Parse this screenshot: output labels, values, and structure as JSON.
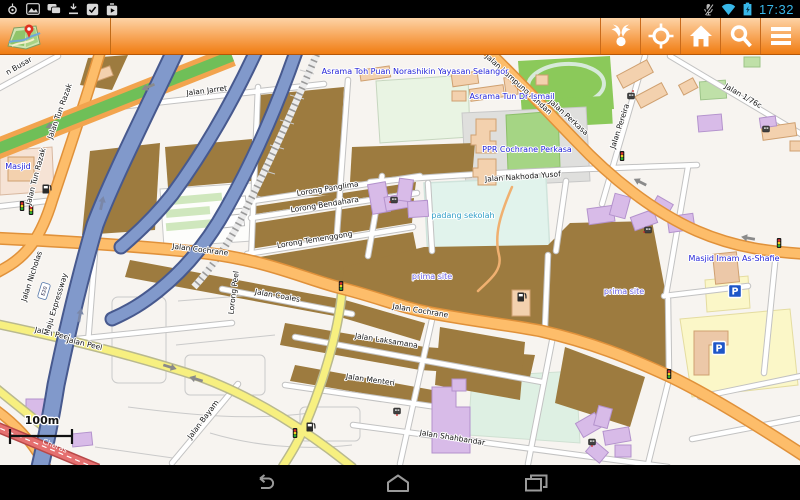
{
  "status_bar": {
    "time": "17:32",
    "left_icons": [
      "gps-active",
      "gallery",
      "messages",
      "download",
      "task-done",
      "play-store"
    ],
    "right_icons": [
      "mic-muted",
      "wifi",
      "battery-charging"
    ]
  },
  "toolbar": {
    "app": "offline-city-map",
    "buttons": [
      {
        "id": "share"
      },
      {
        "id": "my-location"
      },
      {
        "id": "home"
      },
      {
        "id": "search"
      },
      {
        "id": "menu"
      }
    ]
  },
  "map": {
    "scale_label": "100m",
    "route_badge": "E20",
    "parking_label": "P",
    "poi_labels": [
      "Asrama Toh Puan Norashikin Yayasan Selangor",
      "Asrama Tun Dr Ismail",
      "PPR Cochrane Perkasa",
      "Masjid",
      "Masjid Imam As-Shafie",
      "padang sekolah",
      "prima site",
      "prima site"
    ],
    "street_labels": [
      "Jalan Jarret",
      "Jalan Kampung Pandan",
      "Jalan Perkasa",
      "Jalan 1/76c",
      "Jalan Pereira",
      "Jalan Nakhoda Yusof",
      "Lorong Panglima",
      "Lorong Bendahara",
      "Lorong Temenggong",
      "Jalan Cochrane",
      "Jalan Coales",
      "Jalan Cochrane",
      "Jalan Laksamana",
      "Jalan Menteri",
      "Jalan Shahbandar",
      "Jalan Peel",
      "Jalan Peel",
      "Jalan Bayam",
      "Jalan Tun Razak",
      "Jalan Tun Razak",
      "Jalan Nicholas",
      "Maju Expressway",
      "Lorong Peel",
      "Cheras",
      "n Busar"
    ],
    "icon_types": [
      "traffic-light",
      "fuel-station",
      "parking",
      "poi-marker",
      "one-way-arrow"
    ],
    "colors": {
      "residential_brown": "#9d7b3f",
      "main_road_orange": "#fdbd6a",
      "secondary_yellow": "#f7f080",
      "expressway_blue": "#8199cb",
      "trunk_green": "#6fbf58",
      "red_road": "#e57070",
      "field_green": "#8bc95a",
      "padang_cyan": "#e1f3ec",
      "building_purple": "#d8bbe8",
      "building_beige": "#f3d1ae",
      "toolbar_orange": "#f07c12",
      "status_blue": "#38b7e8"
    }
  },
  "nav_bar": {
    "buttons": [
      {
        "id": "back"
      },
      {
        "id": "home"
      },
      {
        "id": "recents"
      }
    ]
  }
}
